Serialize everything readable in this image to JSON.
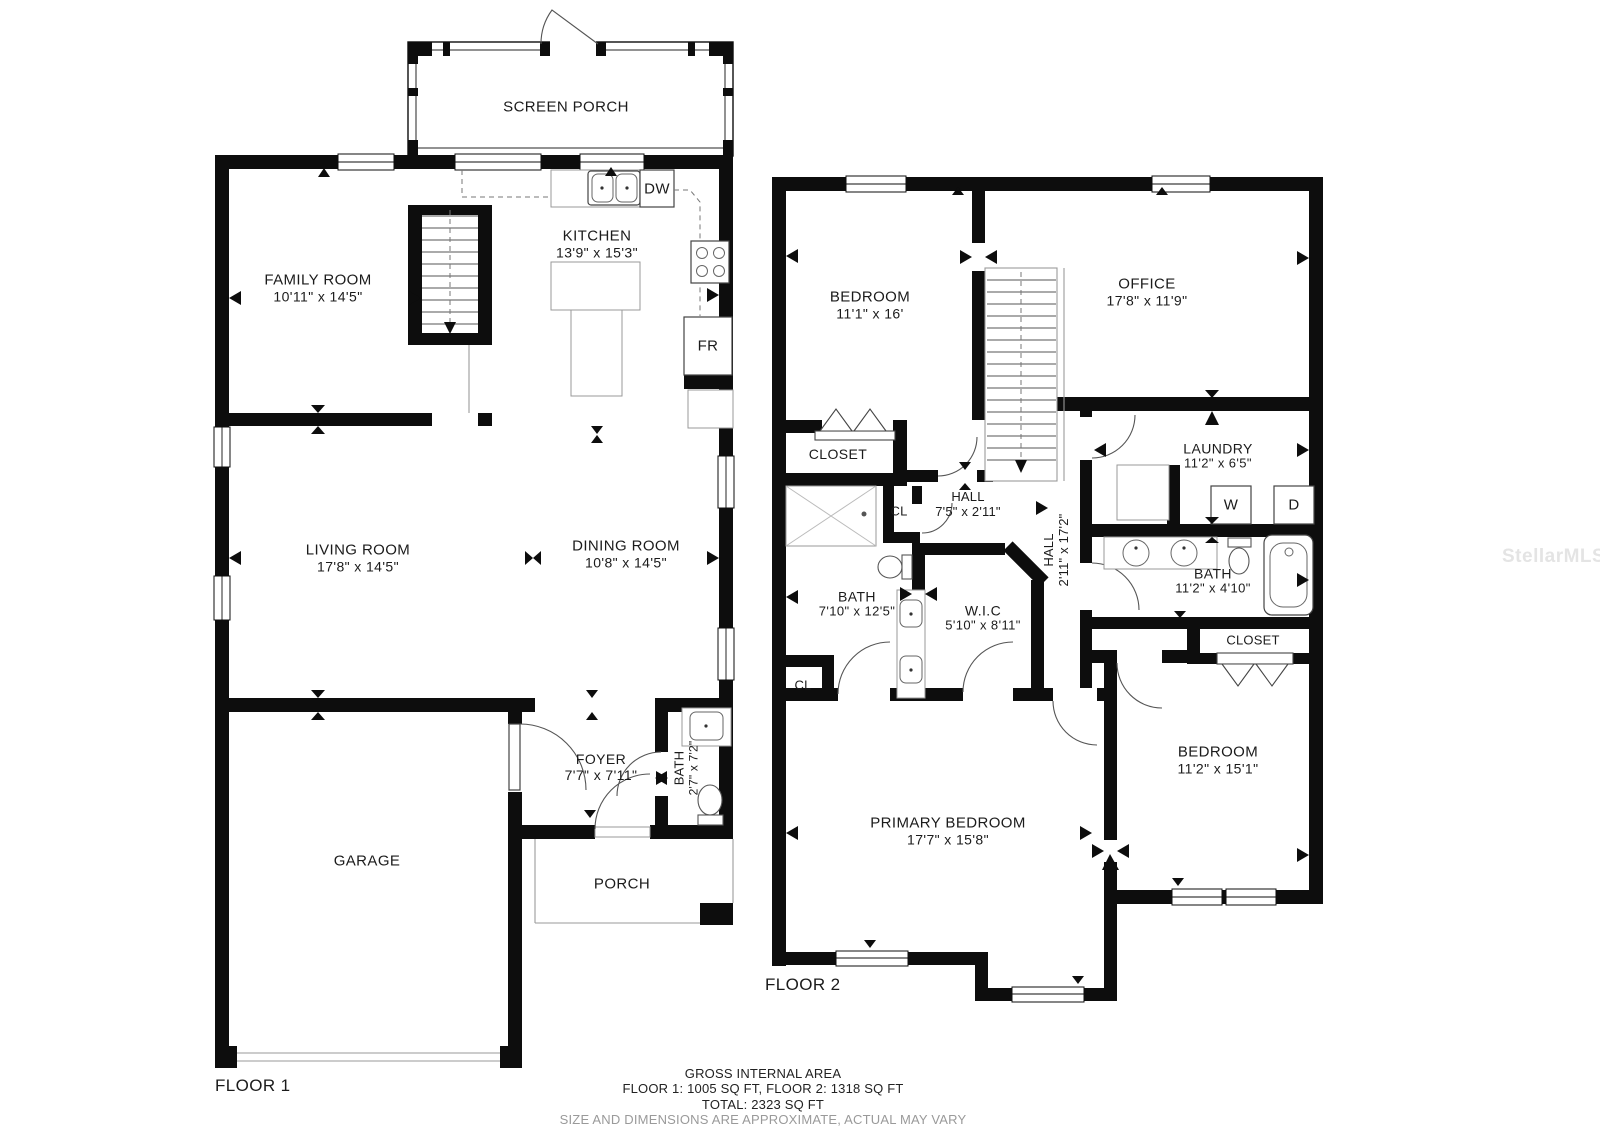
{
  "watermark": "StellarMLS",
  "floor1": {
    "name": "FLOOR 1",
    "rooms": {
      "screen_porch": {
        "name": "SCREEN PORCH"
      },
      "family_room": {
        "name": "FAMILY ROOM",
        "dims": "10'11\" x 14'5\""
      },
      "kitchen": {
        "name": "KITCHEN",
        "dims": "13'9\" x 15'3\""
      },
      "living_room": {
        "name": "LIVING ROOM",
        "dims": "17'8\" x 14'5\""
      },
      "dining_room": {
        "name": "DINING ROOM",
        "dims": "10'8\" x 14'5\""
      },
      "foyer": {
        "name": "FOYER",
        "dims": "7'7\" x 7'11\""
      },
      "bath": {
        "name": "BATH",
        "dims": "2'7\" x 7'2\""
      },
      "garage": {
        "name": "GARAGE"
      },
      "porch": {
        "name": "PORCH"
      }
    },
    "appliances": {
      "dishwasher": "DW",
      "fridge": "FR"
    }
  },
  "floor2": {
    "name": "FLOOR 2",
    "rooms": {
      "bedroom_top": {
        "name": "BEDROOM",
        "dims": "11'1\" x 16'"
      },
      "office": {
        "name": "OFFICE",
        "dims": "17'8\" x 11'9\""
      },
      "closet_left": {
        "name": "CLOSET"
      },
      "cl_upper": {
        "name": "CL"
      },
      "hall_upper": {
        "name": "HALL",
        "dims": "7'5\" x 2'11\""
      },
      "laundry": {
        "name": "LAUNDRY",
        "dims": "11'2\" x 6'5\""
      },
      "bath_right": {
        "name": "BATH",
        "dims": "11'2\" x 4'10\""
      },
      "closet_right": {
        "name": "CLOSET"
      },
      "bath_left": {
        "name": "BATH",
        "dims": "7'10\" x 12'5\""
      },
      "wic": {
        "name": "W.I.C",
        "dims": "5'10\" x 8'11\""
      },
      "cl_lower": {
        "name": "CL"
      },
      "hall_vertical": {
        "name": "HALL",
        "dims": "2'11\" x 17'2\""
      },
      "primary_bedroom": {
        "name": "PRIMARY BEDROOM",
        "dims": "17'7\" x 15'8\""
      },
      "bedroom_bottom": {
        "name": "BEDROOM",
        "dims": "11'2\" x 15'1\""
      }
    },
    "appliances": {
      "washer": "W",
      "dryer": "D"
    }
  },
  "footer": {
    "line1": "GROSS INTERNAL AREA",
    "line2": "FLOOR 1: 1005 SQ FT, FLOOR 2: 1318 SQ FT",
    "line3": "TOTAL: 2323 SQ FT",
    "line4": "SIZE AND DIMENSIONS ARE APPROXIMATE, ACTUAL MAY VARY"
  }
}
